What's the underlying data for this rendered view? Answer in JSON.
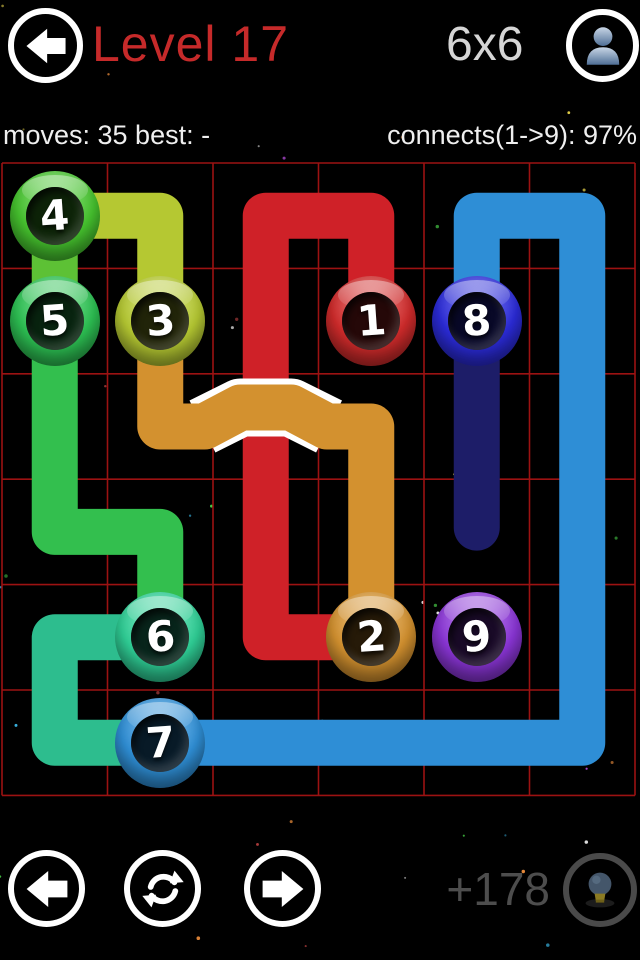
{
  "header": {
    "title": "Level 17",
    "grid_size": "6x6"
  },
  "stats": {
    "left": "moves: 35 best: -",
    "right": "connects(1->9): 97%"
  },
  "footer": {
    "score": "+178"
  },
  "board": {
    "rows": 6,
    "cols": 6,
    "grid_line_color": "#9c1212",
    "bridge_outline_color": "#ffffff",
    "nodes": [
      {
        "n": "1",
        "color": "#d02b2b",
        "col": 3,
        "row": 1
      },
      {
        "n": "2",
        "color": "#d3912f",
        "col": 3,
        "row": 4
      },
      {
        "n": "3",
        "color": "#b5c832",
        "col": 1,
        "row": 1
      },
      {
        "n": "4",
        "color": "#46c32e",
        "col": 0,
        "row": 0
      },
      {
        "n": "5",
        "color": "#2dc153",
        "col": 0,
        "row": 1
      },
      {
        "n": "6",
        "color": "#2fcf96",
        "col": 1,
        "row": 4
      },
      {
        "n": "7",
        "color": "#2f8fd6",
        "col": 1,
        "row": 5
      },
      {
        "n": "8",
        "color": "#2b2bd8",
        "col": 4,
        "row": 1
      },
      {
        "n": "9",
        "color": "#8a35d6",
        "col": 4,
        "row": 4
      }
    ],
    "paths": [
      {
        "name": "8-9",
        "color": "#1d1d68",
        "points": [
          [
            4,
            1
          ],
          [
            4,
            2.96
          ]
        ]
      },
      {
        "name": "7-8",
        "color": "#2e8ed6",
        "points": [
          [
            1,
            5
          ],
          [
            5,
            5
          ],
          [
            5,
            0
          ],
          [
            4,
            0
          ],
          [
            4,
            1
          ]
        ]
      },
      {
        "name": "5-6",
        "color": "#33bf4e",
        "points": [
          [
            0,
            1
          ],
          [
            0,
            3
          ],
          [
            1,
            3
          ],
          [
            1,
            4
          ]
        ]
      },
      {
        "name": "6-7",
        "color": "#2dbd8e",
        "points": [
          [
            1,
            4
          ],
          [
            0,
            4
          ],
          [
            0,
            5
          ],
          [
            1,
            5
          ]
        ]
      },
      {
        "name": "4-5",
        "color": "#5dc135",
        "points": [
          [
            0,
            0
          ],
          [
            0,
            1
          ]
        ]
      },
      {
        "name": "3-4",
        "color": "#b5c832",
        "points": [
          [
            0,
            0
          ],
          [
            1,
            0
          ],
          [
            1,
            1
          ]
        ]
      },
      {
        "name": "1-2",
        "color": "#cf2128",
        "points": [
          [
            3,
            1
          ],
          [
            3,
            0
          ],
          [
            2,
            0
          ],
          [
            2,
            4
          ],
          [
            3,
            4
          ]
        ]
      },
      {
        "name": "2-3",
        "color": "#d3912f",
        "points": [
          [
            1,
            1
          ],
          [
            1,
            2
          ],
          [
            1.42,
            2
          ],
          [
            1.76,
            1.82
          ],
          [
            2.24,
            1.82
          ],
          [
            2.58,
            2
          ],
          [
            3,
            2
          ],
          [
            3,
            4
          ]
        ],
        "bridge_outline": [
          [
            1.4,
            2
          ],
          [
            1.76,
            1.82
          ],
          [
            2.24,
            1.82
          ],
          [
            2.6,
            2
          ]
        ]
      }
    ]
  }
}
